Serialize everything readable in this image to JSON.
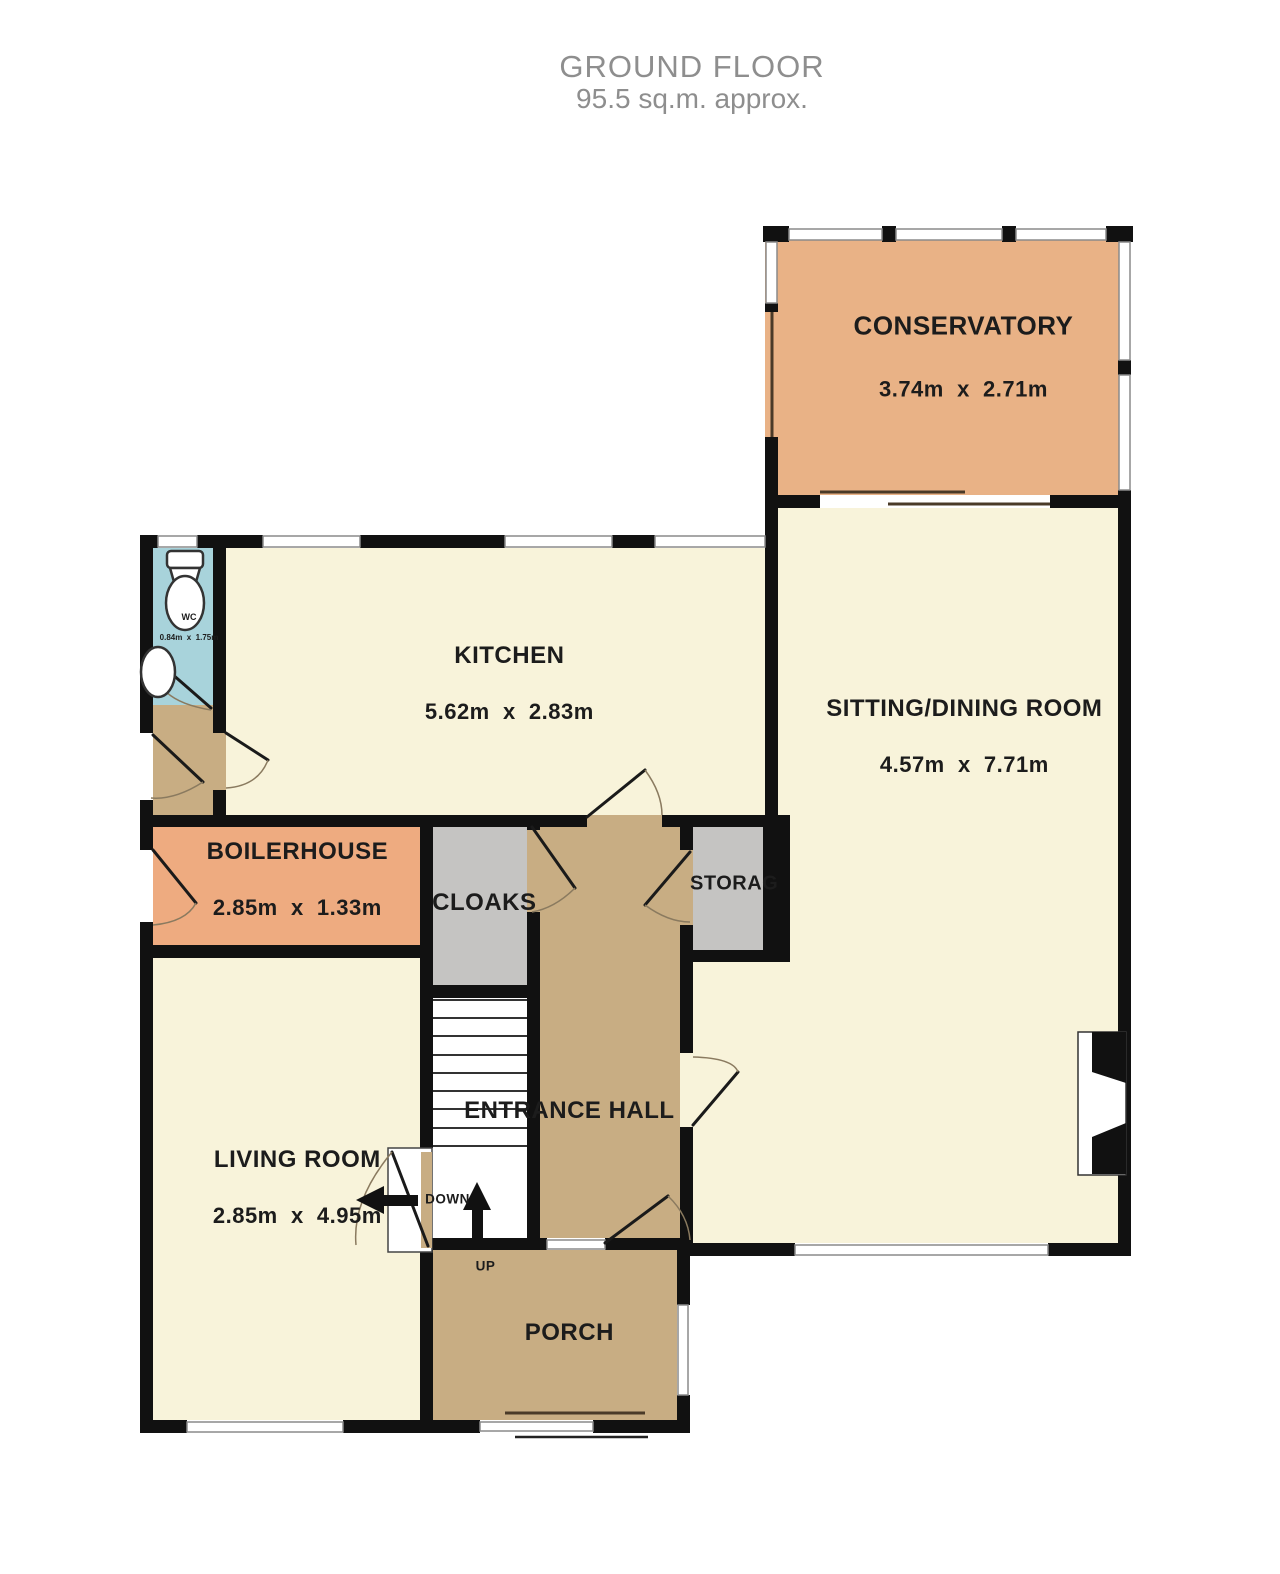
{
  "title": {
    "line1": "GROUND FLOOR",
    "line2": "95.5 sq.m. approx."
  },
  "rooms": {
    "conservatory": {
      "name": "CONSERVATORY",
      "dims": "3.74m  x  2.71m"
    },
    "sitting_dining": {
      "name": "SITTING/DINING ROOM",
      "dims": "4.57m  x  7.71m"
    },
    "kitchen": {
      "name": "KITCHEN",
      "dims": "5.62m  x  2.83m"
    },
    "wc": {
      "name": "WC",
      "dims": "0.84m  x  1.75m"
    },
    "boilerhouse": {
      "name": "BOILERHOUSE",
      "dims": "2.85m  x  1.33m"
    },
    "cloaks": {
      "name": "CLOAKS"
    },
    "storage": {
      "name": "STORAG"
    },
    "entrance_hall": {
      "name": "ENTRANCE HALL"
    },
    "living_room": {
      "name": "LIVING ROOM",
      "dims": "2.85m  x  4.95m"
    },
    "porch": {
      "name": "PORCH"
    }
  },
  "stairs": {
    "up_label": "UP",
    "down_label": "DOWN"
  },
  "colors": {
    "wall": "#111111",
    "cream": "#f8f3da",
    "tan": "#c8ad83",
    "orange": "#e9b286",
    "salmon": "#eeab80",
    "blue": "#a8d3db",
    "gray": "#c5c4c2",
    "title-gray": "#8e8e8e",
    "label": "#1c1c1c",
    "win-edge": "#8a8a8a"
  }
}
